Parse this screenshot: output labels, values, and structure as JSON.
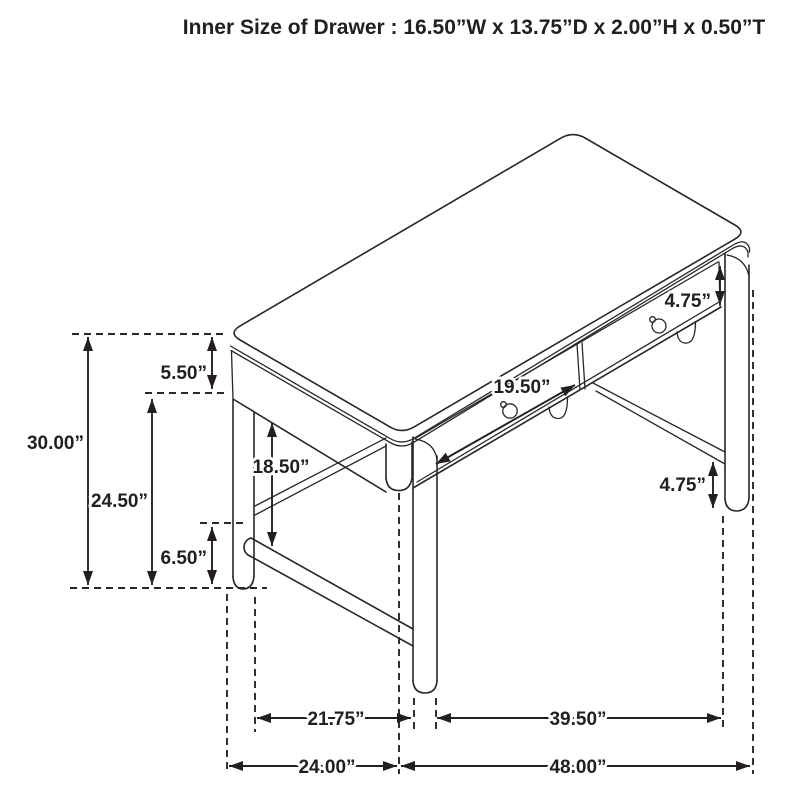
{
  "title": "Inner Size of Drawer : 16.50”W x 13.75”D x 2.00”H x 0.50”T",
  "colors": {
    "line": "#2a2627",
    "dimension": "#231f20",
    "background": "#ffffff"
  },
  "subject_icon": "desk-line-drawing-icon",
  "dimensions": [
    {
      "id": "overall-height",
      "label": "30.00”",
      "arrow": {
        "x1": 88,
        "y1": 337,
        "x2": 88,
        "y2": 585
      },
      "label_pos": {
        "x": 84,
        "y": 449,
        "anchor": "end"
      }
    },
    {
      "id": "top-section-height",
      "label": "5.50”",
      "arrow": {
        "x1": 212,
        "y1": 337,
        "x2": 212,
        "y2": 389
      },
      "label_pos": {
        "x": 207,
        "y": 379,
        "anchor": "end"
      }
    },
    {
      "id": "floor-to-apron-height",
      "label": "24.50”",
      "arrow": {
        "x1": 152,
        "y1": 399,
        "x2": 152,
        "y2": 585
      },
      "label_pos": {
        "x": 148,
        "y": 507,
        "anchor": "end"
      }
    },
    {
      "id": "leg-clearance",
      "label": "18.50”",
      "arrow": {
        "x1": 272,
        "y1": 423,
        "x2": 272,
        "y2": 546
      },
      "label_pos": {
        "x": 281,
        "y": 473,
        "anchor": "middle"
      }
    },
    {
      "id": "stretcher-height",
      "label": "6.50”",
      "arrow": {
        "x1": 212,
        "y1": 527,
        "x2": 212,
        "y2": 584
      },
      "label_pos": {
        "x": 207,
        "y": 564,
        "anchor": "end"
      }
    },
    {
      "id": "drawer-front-width",
      "label": "19.50”",
      "arrow": {
        "x1": 436,
        "y1": 464,
        "x2": 575,
        "y2": 385
      },
      "label_pos": {
        "x": 522,
        "y": 393,
        "anchor": "middle"
      }
    },
    {
      "id": "apron-height",
      "label": "4.75”",
      "arrow": {
        "x1": 720,
        "y1": 266,
        "x2": 720,
        "y2": 305
      },
      "label_pos": {
        "x": 711,
        "y": 307,
        "anchor": "end"
      }
    },
    {
      "id": "stretcher-floor-gap",
      "label": "4.75”",
      "arrow": {
        "x1": 713,
        "y1": 462,
        "x2": 713,
        "y2": 508
      },
      "label_pos": {
        "x": 706,
        "y": 491,
        "anchor": "end"
      }
    },
    {
      "id": "side-leg-span",
      "label": "21.75”",
      "arrow": {
        "x1": 257,
        "y1": 718,
        "x2": 411,
        "y2": 718
      },
      "label_pos": {
        "x": 336,
        "y": 725,
        "anchor": "middle"
      }
    },
    {
      "id": "front-leg-span",
      "label": "39.50”",
      "arrow": {
        "x1": 437,
        "y1": 718,
        "x2": 721,
        "y2": 718
      },
      "label_pos": {
        "x": 578,
        "y": 725,
        "anchor": "middle"
      }
    },
    {
      "id": "overall-depth",
      "label": "24.00”",
      "arrow": {
        "x1": 229,
        "y1": 766,
        "x2": 397,
        "y2": 766
      },
      "label_pos": {
        "x": 327,
        "y": 773,
        "anchor": "middle"
      }
    },
    {
      "id": "overall-width",
      "label": "48.00”",
      "arrow": {
        "x1": 401,
        "y1": 766,
        "x2": 750,
        "y2": 766
      },
      "label_pos": {
        "x": 578,
        "y": 773,
        "anchor": "middle"
      }
    }
  ],
  "guides": [
    {
      "id": "top-surface-level",
      "x1": 72,
      "y1": 334,
      "x2": 227,
      "y2": 334
    },
    {
      "id": "apron-bottom-level",
      "x1": 145,
      "y1": 393,
      "x2": 228,
      "y2": 393
    },
    {
      "id": "stretcher-top-level",
      "x1": 200,
      "y1": 523,
      "x2": 247,
      "y2": 523
    },
    {
      "id": "floor-level",
      "x1": 70,
      "y1": 588,
      "x2": 267,
      "y2": 588
    },
    {
      "id": "left-corner-extension",
      "x1": 227,
      "y1": 594,
      "x2": 227,
      "y2": 774
    },
    {
      "id": "rear-left-leg-extension",
      "x1": 255,
      "y1": 597,
      "x2": 255,
      "y2": 732
    },
    {
      "id": "front-corner-extension",
      "x1": 399,
      "y1": 493,
      "x2": 399,
      "y2": 774
    },
    {
      "id": "front-leg-left-extension",
      "x1": 414,
      "y1": 698,
      "x2": 414,
      "y2": 732
    },
    {
      "id": "front-leg-right-extension",
      "x1": 436,
      "y1": 698,
      "x2": 436,
      "y2": 732
    },
    {
      "id": "right-leg-extension",
      "x1": 723,
      "y1": 516,
      "x2": 723,
      "y2": 732
    },
    {
      "id": "right-corner-extension",
      "x1": 753,
      "y1": 290,
      "x2": 753,
      "y2": 774
    }
  ]
}
